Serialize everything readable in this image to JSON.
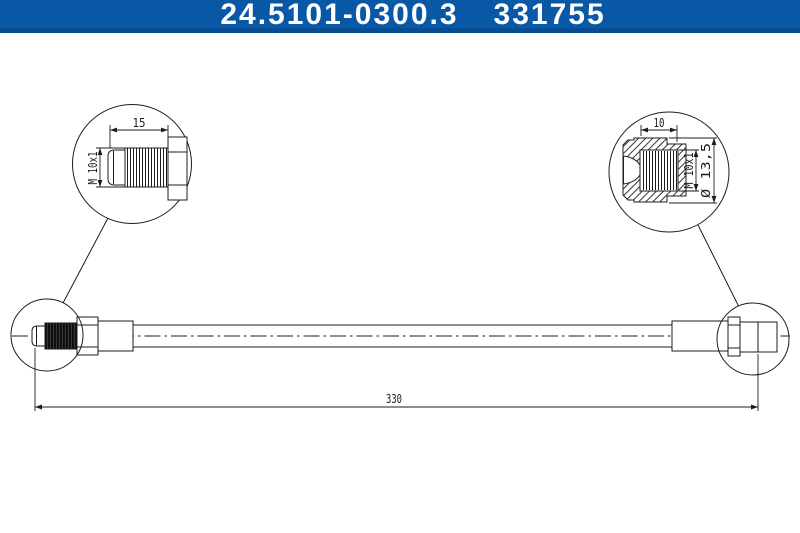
{
  "header": {
    "part_number": "24.5101-0300.3",
    "reference_number": "331755"
  },
  "colors": {
    "header-bg": "#0958a6",
    "header-bg-dark": "#074c92",
    "header-text": "#ffffff",
    "line": "#1c1c1c",
    "canvas-bg": "#ffffff"
  },
  "drawing": {
    "type": "technical-drawing-brake-hose",
    "detail_left": {
      "length_label": "15",
      "thread_label": "M 10x1"
    },
    "detail_right": {
      "depth_label": "10",
      "thread_label": "M 10x1",
      "diameter_label": "Ø 13,5"
    },
    "overall_length_label": "330"
  }
}
